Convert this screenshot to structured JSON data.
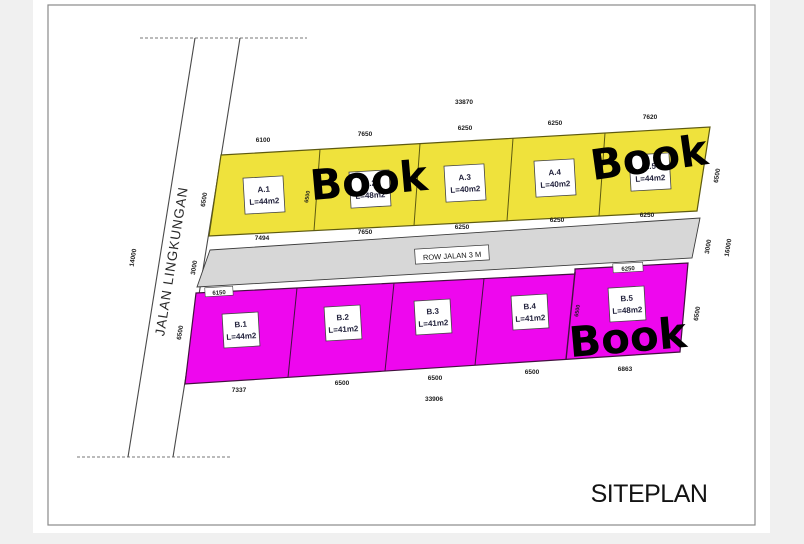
{
  "page": {
    "title": "SITEPLAN",
    "watermark": "Book"
  },
  "roads": {
    "left_name": "JALAN LINGKUNGAN",
    "left_length": "14000",
    "row_label": "ROW JALAN 3 M"
  },
  "row_a": {
    "plots": [
      {
        "id": "A.1",
        "area": "L=44m2"
      },
      {
        "id": "A.2",
        "area": "L=48m2"
      },
      {
        "id": "A.3",
        "area": "L=40m2"
      },
      {
        "id": "A.4",
        "area": "L=40m2"
      },
      {
        "id": "A.5",
        "area": "L=44m2"
      }
    ]
  },
  "row_b": {
    "plots": [
      {
        "id": "B.1",
        "area": "L=44m2"
      },
      {
        "id": "B.2",
        "area": "L=41m2"
      },
      {
        "id": "B.3",
        "area": "L=41m2"
      },
      {
        "id": "B.4",
        "area": "L=41m2"
      },
      {
        "id": "B.5",
        "area": "L=48m2"
      }
    ]
  },
  "dims": {
    "a_top": [
      "6100",
      "7650",
      "6250",
      "6250",
      "7620"
    ],
    "a_top_total": "33870",
    "a_bottom": [
      "7494",
      "7650",
      "6250",
      "6250",
      "6250"
    ],
    "a_left_depth": "6500",
    "a_divider": "6500",
    "road_left": "3000",
    "b_top_b1": "6150",
    "b_top_b5": "6250",
    "b_divider": "6500",
    "b_left_depth": "6500",
    "b_bottom": [
      "7337",
      "6500",
      "6500",
      "6500",
      "6863"
    ],
    "b_bottom_total": "33906",
    "right_a_depth": "6500",
    "right_road": "3000",
    "right_total": "16000",
    "right_b_depth": "6500"
  },
  "colors": {
    "background": "#F0F0F0",
    "sheet": "#FFFFFF",
    "frame": "#8A8A8A",
    "plot_a": "#EFE23C",
    "plot_b": "#EE07EE",
    "road": "#D7D7D7",
    "outline": "#3F3F30",
    "watermark": "#000000"
  }
}
